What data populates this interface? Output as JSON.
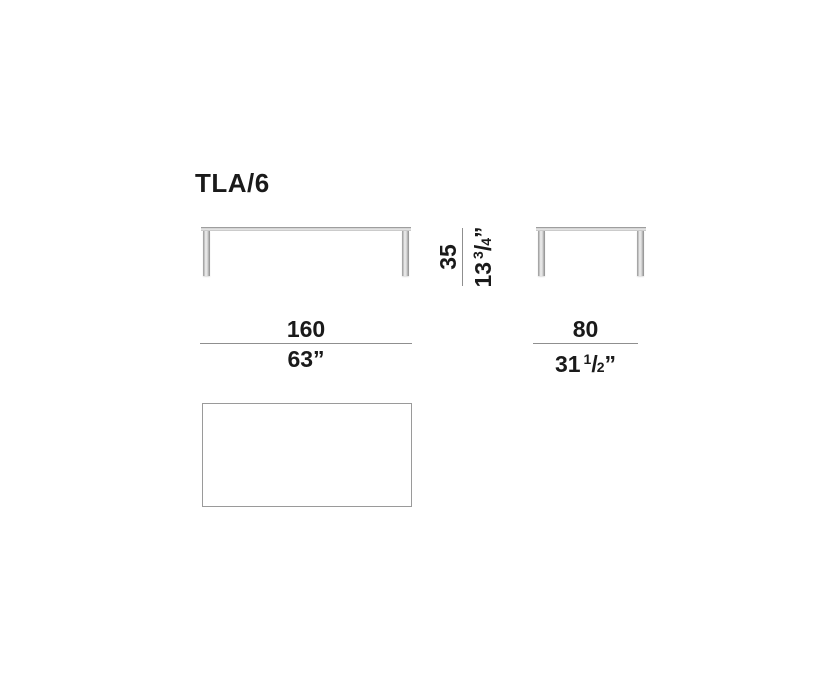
{
  "page": {
    "title": "TLA/6"
  },
  "dimensions": {
    "height": {
      "metric": "35",
      "imperial_whole": "13",
      "imperial_frac_num": "3",
      "imperial_frac_den": "4",
      "imperial_unit": "”"
    },
    "width": {
      "metric": "160",
      "imperial_whole": "63",
      "imperial_unit": "”"
    },
    "depth": {
      "metric": "80",
      "imperial_whole": "31",
      "imperial_frac_num": "1",
      "imperial_frac_den": "2",
      "imperial_unit": "”"
    }
  },
  "colors": {
    "text": "#1a1a1a",
    "dim_line": "#8f8f8f",
    "outline": "#9a9a9a"
  }
}
